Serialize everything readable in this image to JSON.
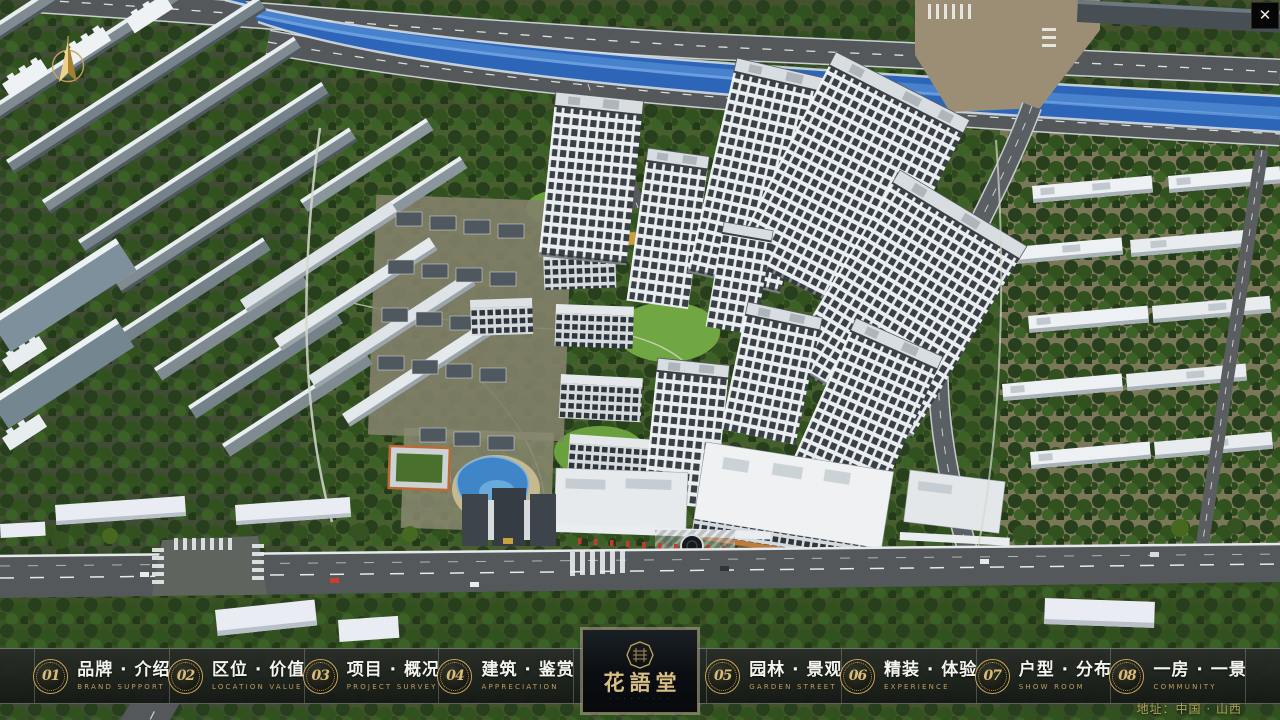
{
  "ui": {
    "close_glyph": "✕",
    "address": "地址：中国 · 山西"
  },
  "logo": {
    "name": "花語堂",
    "tagline": "· · · · · · · · ·"
  },
  "nav": {
    "items": [
      {
        "num": "01",
        "label": "品牌 · 介绍",
        "sublabel": "BRAND SUPPORT"
      },
      {
        "num": "02",
        "label": "区位 · 价值",
        "sublabel": "LOCATION VALUE"
      },
      {
        "num": "03",
        "label": "项目 · 概况",
        "sublabel": "PROJECT SURVEY"
      },
      {
        "num": "04",
        "label": "建筑 · 鉴赏",
        "sublabel": "APPRECIATION"
      },
      {
        "num": "05",
        "label": "园林 · 景观",
        "sublabel": "GARDEN STREET"
      },
      {
        "num": "06",
        "label": "精装 · 体验",
        "sublabel": "EXPERIENCE"
      },
      {
        "num": "07",
        "label": "户型 · 分布",
        "sublabel": "SHOW ROOM"
      },
      {
        "num": "08",
        "label": "一房 · 一景",
        "sublabel": "COMMUNITY"
      }
    ]
  },
  "colors": {
    "accent_gold": "#c9a35e",
    "bar_bg": "#1c211c",
    "river_blue": "#2f6fc4",
    "tree_green": "#31511f",
    "road_gray": "#54585b",
    "flag_red": "#c63c2c"
  }
}
